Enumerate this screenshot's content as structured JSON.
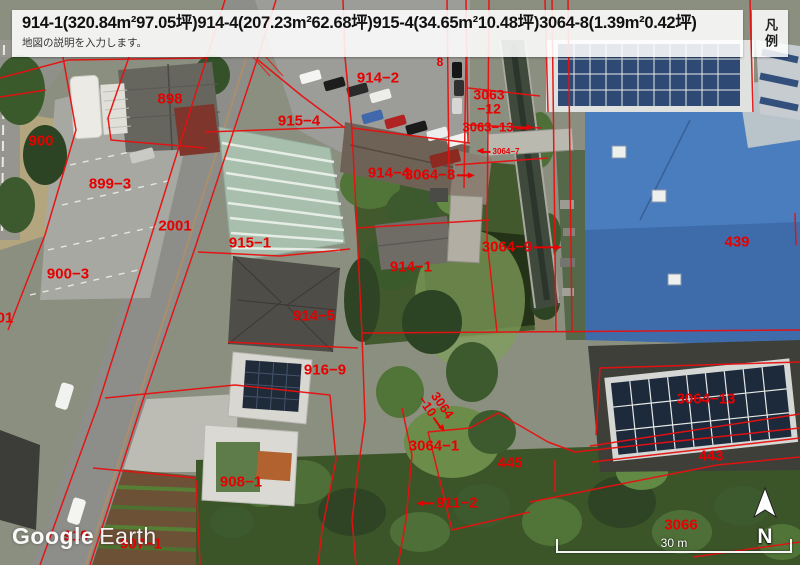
{
  "header": {
    "title": "914-1(320.84m²97.05坪)914-4(207.23m²62.68坪)915-4(34.65m²10.48坪)3064-8(1.39m²0.42坪)",
    "subtitle": "地図の説明を入力します。",
    "legend_label": "凡例"
  },
  "map": {
    "watermark": {
      "brand": "Google",
      "product": "Earth"
    },
    "compass": {
      "letter": "N"
    },
    "scale": {
      "text": "30 m"
    },
    "colors": {
      "parcel_line": "#e60000",
      "parcel_label": "#e60000"
    },
    "labels": [
      {
        "text": "898",
        "x": 170,
        "y": 99
      },
      {
        "text": "900",
        "x": 41,
        "y": 141
      },
      {
        "text": "899−3",
        "x": 110,
        "y": 184
      },
      {
        "text": "2001",
        "x": 175,
        "y": 226
      },
      {
        "text": "900−3",
        "x": 68,
        "y": 274
      },
      {
        "text": "01",
        "x": 5,
        "y": 318
      },
      {
        "text": "915−4",
        "x": 299,
        "y": 121
      },
      {
        "text": "915−1",
        "x": 250,
        "y": 243
      },
      {
        "text": "914−2",
        "x": 378,
        "y": 78
      },
      {
        "text": "914−4",
        "x": 389,
        "y": 173
      },
      {
        "text": "8",
        "x": 440,
        "y": 62,
        "size": 12
      },
      {
        "text": "3064−8",
        "x": 438,
        "y": 175,
        "arrow": "right"
      },
      {
        "lines": [
          "3063",
          "−12"
        ],
        "x": 489,
        "y": 102,
        "size": 14
      },
      {
        "text": "3063−13",
        "x": 496,
        "y": 127,
        "size": 13,
        "arrow": "right"
      },
      {
        "text": "3064−7",
        "x": 500,
        "y": 152,
        "size": 8,
        "arrow": "left",
        "arrowLen": 8
      },
      {
        "text": "914−1",
        "x": 411,
        "y": 267
      },
      {
        "text": "914−5",
        "x": 314,
        "y": 316
      },
      {
        "text": "916−9",
        "x": 325,
        "y": 370
      },
      {
        "text": "3064−9",
        "x": 520,
        "y": 247,
        "arrow": "right",
        "arrowLen": 22
      },
      {
        "text": "439",
        "x": 737,
        "y": 242
      },
      {
        "text": "3064−13",
        "x": 706,
        "y": 399
      },
      {
        "text": "443",
        "x": 711,
        "y": 456
      },
      {
        "lines": [
          "3064",
          "−10"
        ],
        "x": 437,
        "y": 409,
        "size": 13,
        "rotate": 55,
        "arrow": "right"
      },
      {
        "text": "3064−1",
        "x": 434,
        "y": 446
      },
      {
        "text": "445",
        "x": 510,
        "y": 463
      },
      {
        "text": "911−2",
        "x": 449,
        "y": 503,
        "arrow": "left"
      },
      {
        "text": "908−1",
        "x": 241,
        "y": 482
      },
      {
        "text": "910",
        "x": 76,
        "y": 536
      },
      {
        "text": "907−1",
        "x": 141,
        "y": 544
      },
      {
        "text": "3066",
        "x": 681,
        "y": 525
      }
    ]
  }
}
